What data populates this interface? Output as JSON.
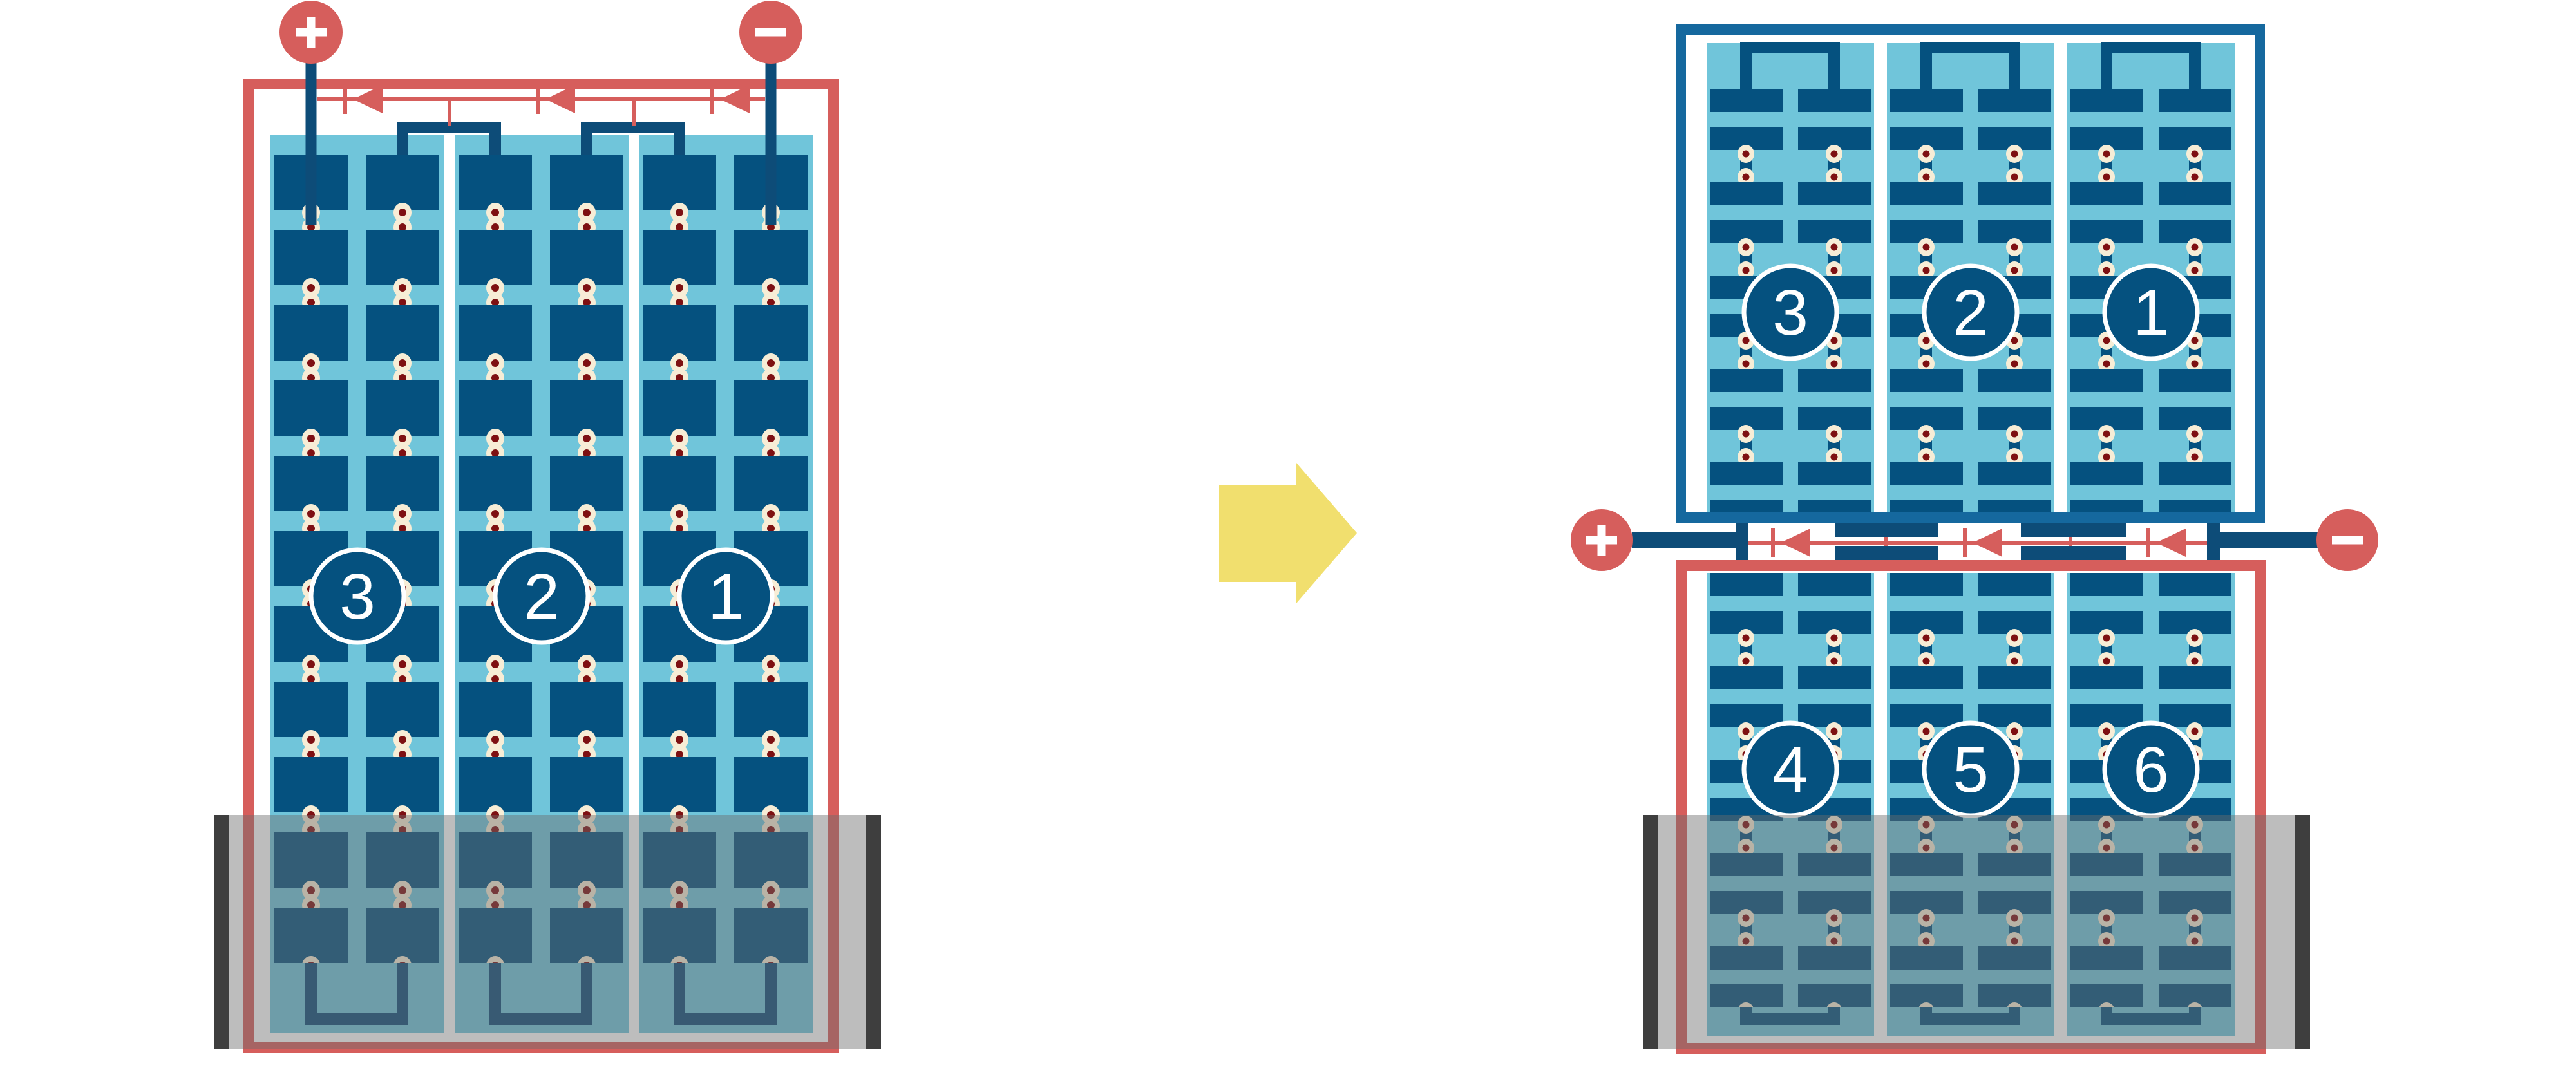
{
  "diagram_title": "",
  "palette": {
    "red": "#D65E5C",
    "cell_blue": "#05517F",
    "frame_blue": "#15689E",
    "connector_navy": "#0D4C78",
    "light_blue": "#70C5DA",
    "rivet_ring": "#F7EDD6",
    "rivet_core": "#7E1012",
    "arrow_yellow": "#F1DF6E",
    "rail_cap_gray": "#3E3E3E"
  },
  "left_module": {
    "positive_terminal_sign": "+",
    "negative_terminal_sign": "−",
    "bypass_diode_count": 3,
    "strings": [
      {
        "label": "3"
      },
      {
        "label": "2"
      },
      {
        "label": "1"
      }
    ]
  },
  "arrow": {
    "direction": "right"
  },
  "right_assembly": {
    "positive_terminal_sign": "+",
    "negative_terminal_sign": "−",
    "bypass_diode_count": 3,
    "top_module": {
      "strings": [
        {
          "label": "3"
        },
        {
          "label": "2"
        },
        {
          "label": "1"
        }
      ]
    },
    "bottom_module": {
      "strings": [
        {
          "label": "4"
        },
        {
          "label": "5"
        },
        {
          "label": "6"
        }
      ]
    }
  }
}
